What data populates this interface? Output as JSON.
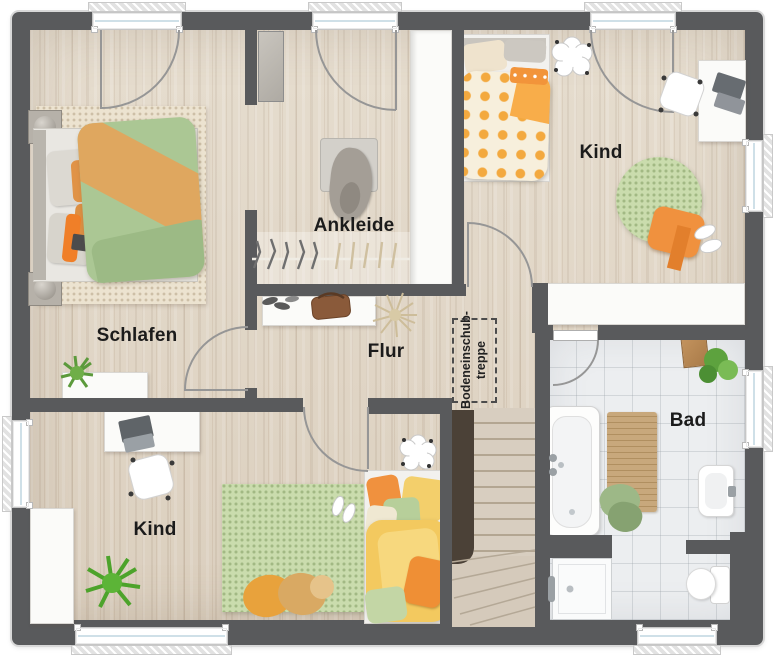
{
  "floor_plan": {
    "rooms": [
      {
        "key": "schlafen",
        "label": "Schlafen"
      },
      {
        "key": "ankleide",
        "label": "Ankleide"
      },
      {
        "key": "kind-top-right",
        "label": "Kind"
      },
      {
        "key": "flur",
        "label": "Flur"
      },
      {
        "key": "kind-bottom-left",
        "label": "Kind"
      },
      {
        "key": "bad",
        "label": "Bad"
      }
    ],
    "attic_ladder": {
      "line1": "Bodeneinschub-",
      "line2": "treppe"
    },
    "colors": {
      "wall": "#595a5c",
      "wood_floor": "#e3d9c9",
      "tile_floor": "#eceef0",
      "arc": "#969696",
      "stair_dark": "#4b4137",
      "rug_green": "#cadcad",
      "accent_orange": "#f0913e",
      "accent_green": "#abc794",
      "accent_yellow": "#f3c95f"
    }
  }
}
